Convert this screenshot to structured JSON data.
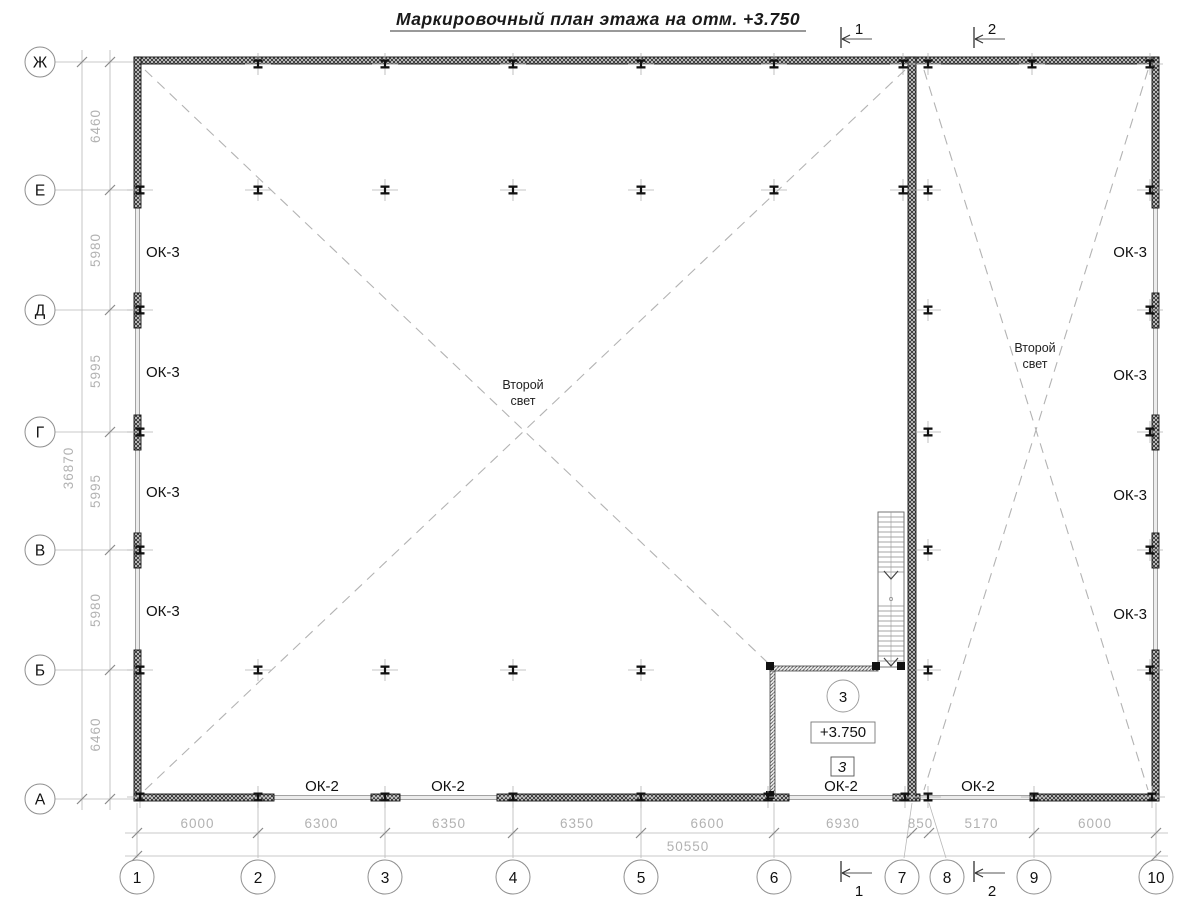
{
  "title": "Маркировочный план этажа на отм. +3.750",
  "axes": {
    "rows": [
      "Ж",
      "Е",
      "Д",
      "Г",
      "В",
      "Б",
      "А"
    ],
    "cols": [
      "1",
      "2",
      "3",
      "4",
      "5",
      "6",
      "7",
      "8",
      "9",
      "10"
    ]
  },
  "dimensions": {
    "left": {
      "segments": [
        "6460",
        "5980",
        "5995",
        "5995",
        "5980",
        "6460"
      ],
      "total": "36870"
    },
    "bottom": {
      "segments": [
        "6000",
        "6300",
        "6350",
        "6350",
        "6600",
        "6930",
        "850",
        "5170",
        "6000"
      ],
      "total": "50550"
    }
  },
  "window_marks": {
    "left": [
      "ОК-3",
      "ОК-3",
      "ОК-3",
      "ОК-3"
    ],
    "right": [
      "ОК-3",
      "ОК-3",
      "ОК-3",
      "ОК-3"
    ],
    "bottom": [
      "ОК-2",
      "ОК-2",
      "ОК-2",
      "ОК-2"
    ]
  },
  "void_labels": [
    {
      "line1": "Второй",
      "line2": "свет"
    },
    {
      "line1": "Второй",
      "line2": "свет"
    }
  ],
  "room": {
    "number": "3",
    "elevation": "+3.750",
    "door_mark": "3"
  },
  "section_marks": {
    "top": [
      "1",
      "2"
    ],
    "bottom": [
      "1",
      "2"
    ]
  },
  "colors": {
    "wall_hatch": "#2b2b2b",
    "wall_bg": "#d9d9d9",
    "thin_line": "#8f8f8f",
    "window_fill": "#ececec",
    "dim_line": "#b8b8b8",
    "dim_text": "#b2b2b2",
    "dashed": "#b3b3b3",
    "text": "#1a1a1a"
  }
}
